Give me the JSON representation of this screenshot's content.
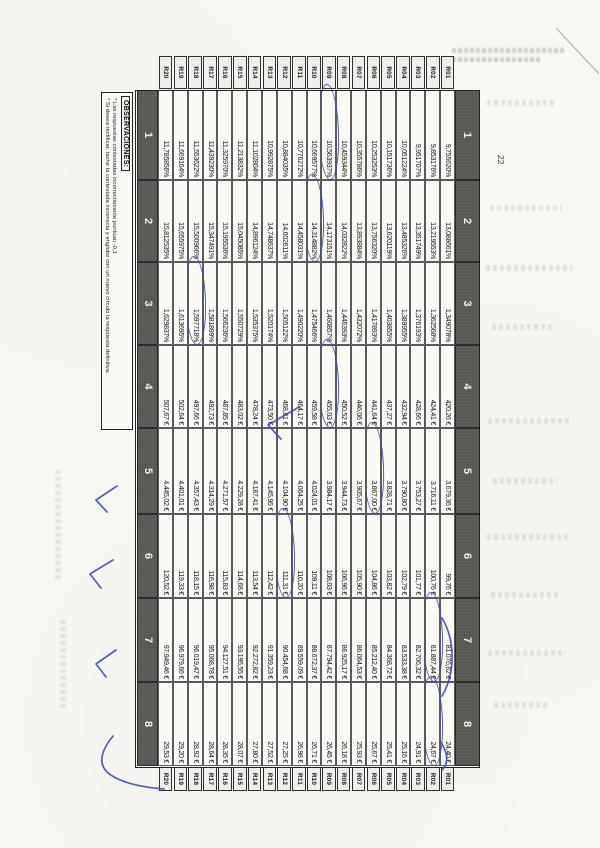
{
  "page": {
    "number": "22"
  },
  "observaciones": {
    "title": "OBSERVACIONES:",
    "line1": "* Las respuestas contestadas incorrectamente puntúan -0,1",
    "line2": "* Si desea rectificar, tache la contestada incorrecta y englobe con un nuevo círculo la respuesta definitiva."
  },
  "table": {
    "column_headers": [
      "1",
      "2",
      "3",
      "4",
      "5",
      "6",
      "7",
      "8"
    ],
    "rows": [
      {
        "label": "R01",
        "values": [
          "9,755620%",
          "13,088661%",
          "1,349078%",
          "420,26 €",
          "3.679,36 €",
          "99,76 €",
          "81.076,62 €",
          "24,40 €"
        ]
      },
      {
        "label": "R02",
        "values": [
          "9,853176%",
          "13,219553%",
          "1,362568%",
          "424,41 €",
          "3.716,11 €",
          "100,76 €",
          "81.887,44 €",
          "24,67 €"
        ]
      },
      {
        "label": "R03",
        "values": [
          "9,951707%",
          "13,351749%",
          "1,376193%",
          "428,66 €",
          "3.753,27 €",
          "101,77 €",
          "82.706,32 €",
          "24,91 €"
        ]
      },
      {
        "label": "R04",
        "values": [
          "10,051224%",
          "13,485326%",
          "1,389955%",
          "432,94 €",
          "3.790,80 €",
          "102,79 €",
          "83.533,38 €",
          "25,16 €"
        ]
      },
      {
        "label": "R05",
        "values": [
          "10,151736%",
          "13,620119%",
          "1,403855%",
          "437,27 €",
          "3.828,71 €",
          "103,82 €",
          "84.368,72 €",
          "25,41 €"
        ]
      },
      {
        "label": "R06",
        "values": [
          "10,253253%",
          "13,756320%",
          "1,417893%",
          "441,64 €",
          "3.867,00 €",
          "104,86 €",
          "85.212,40 €",
          "25,67 €"
        ]
      },
      {
        "label": "R07",
        "values": [
          "10,355786%",
          "13,893884%",
          "1,432072%",
          "446,06 €",
          "3.905,67 €",
          "105,90 €",
          "86.064,53 €",
          "25,93 €"
        ]
      },
      {
        "label": "R08",
        "values": [
          "10,459344%",
          "14,032822%",
          "1,446393%",
          "450,52 €",
          "3.944,73 €",
          "106,96 €",
          "86.925,17 €",
          "26,18 €"
        ]
      },
      {
        "label": "R09",
        "values": [
          "10,563937%",
          "14,173151%",
          "1,460857%",
          "455,03 €",
          "3.984,17 €",
          "108,03 €",
          "87.794,42 €",
          "26,45 €"
        ]
      },
      {
        "label": "R10",
        "values": [
          "10,669577%",
          "14,314882%",
          "1,475466%",
          "459,58 €",
          "4.024,01 €",
          "109,11 €",
          "88.672,37 €",
          "26,71 €"
        ]
      },
      {
        "label": "R11",
        "values": [
          "10,776272%",
          "14,458031%",
          "1,490220%",
          "464,17 €",
          "4.064,25 €",
          "110,20 €",
          "89.559,09 €",
          "26,98 €"
        ]
      },
      {
        "label": "R12",
        "values": [
          "10,884035%",
          "14,602611%",
          "1,505122%",
          "468,81 €",
          "4.104,90 €",
          "111,31 €",
          "90.454,68 €",
          "27,25 €"
        ]
      },
      {
        "label": "R13",
        "values": [
          "10,992875%",
          "14,748637%",
          "1,520174%",
          "473,50 €",
          "4.145,95 €",
          "112,42 €",
          "91.359,23 €",
          "27,52 €"
        ]
      },
      {
        "label": "R14",
        "values": [
          "11,102804%",
          "14,896124%",
          "1,535375%",
          "478,24 €",
          "4.187,41 €",
          "113,54 €",
          "92.272,82 €",
          "27,80 €"
        ]
      },
      {
        "label": "R15",
        "values": [
          "11,213832%",
          "15,045085%",
          "1,550729%",
          "483,02 €",
          "4.229,28 €",
          "114,68 €",
          "93.195,55 €",
          "28,07 €"
        ]
      },
      {
        "label": "R16",
        "values": [
          "11,325970%",
          "15,195536%",
          "1,566236%",
          "487,85 €",
          "4.271,57 €",
          "115,83 €",
          "94.127,51 €",
          "28,35 €"
        ]
      },
      {
        "label": "R17",
        "values": [
          "11,439230%",
          "15,347491%",
          "1,581899%",
          "492,73 €",
          "4.314,29 €",
          "116,98 €",
          "95.068,78 €",
          "28,64 €"
        ]
      },
      {
        "label": "R18",
        "values": [
          "11,553622%",
          "15,500966%",
          "1,597718%",
          "497,66 €",
          "4.357,43 €",
          "118,15 €",
          "96.019,47 €",
          "28,92 €"
        ]
      },
      {
        "label": "R19",
        "values": [
          "11,669164%",
          "15,655975%",
          "1,613695%",
          "502,64 €",
          "4.401,01 €",
          "119,33 €",
          "96.979,66 €",
          "29,20 €"
        ]
      },
      {
        "label": "R20",
        "values": [
          "11,785856%",
          "15,812535%",
          "1,629837%",
          "507,67 €",
          "4.445,02 €",
          "120,52 €",
          "97.949,46 €",
          "29,53 €"
        ]
      }
    ],
    "circled_answers": [
      {
        "row": "R09",
        "col": 1
      },
      {
        "row": "R10",
        "col": 2
      },
      {
        "row": "R18",
        "col": 3
      },
      {
        "row": "R09",
        "col": 4
      },
      {
        "row": "R06",
        "col": 5
      },
      {
        "row": "R12",
        "col": 6
      },
      {
        "row": "R02",
        "col": 7
      },
      {
        "row": "R02",
        "col": 8
      }
    ]
  },
  "annotations": {
    "pen_color": "#3b4da5",
    "pencil_color": "#a39d92",
    "margin_checkmarks": 4,
    "table_checkmarks": 1
  }
}
